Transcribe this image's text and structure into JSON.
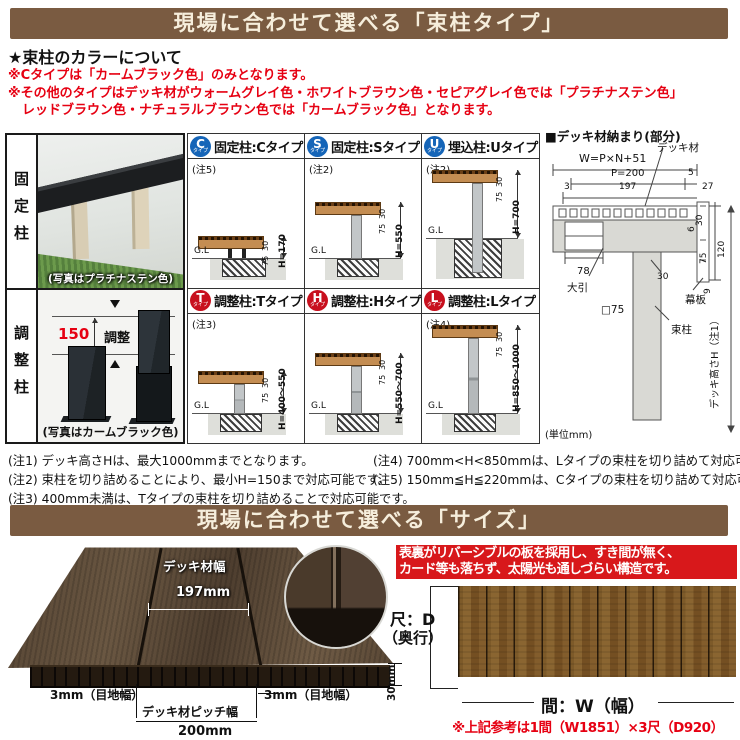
{
  "colors": {
    "banner_bg": "#7a5b41",
    "banner_text": "#f6eedc",
    "accent_red": "#e60012",
    "type_blue": "#1565b8",
    "type_red": "#c8101e",
    "feature_box_bg": "#d8181b"
  },
  "banner1": {
    "title": "現場に合わせて選べる「束柱タイプ」"
  },
  "color_info": {
    "heading": "★束柱のカラーについて",
    "line1": "※Cタイプは「カームブラック色」のみとなります。",
    "line2": "※その他のタイプはデッキ材がウォームグレイ色・ホワイトブラウン色・セピアグレイ色では「プラチナステン色」",
    "line3": "レッドブラウン色・ナチュラルブラウン色では「カームブラック色」となります。"
  },
  "left_panel": {
    "fixed": {
      "label": "固定柱",
      "caption": "(写真はプラチナステン色)"
    },
    "adjust": {
      "label": "調整柱",
      "dim": "150",
      "dim_text": "調整",
      "caption": "(写真はカームブラック色)"
    }
  },
  "type_table": {
    "unit": "(単位mm)",
    "gl": "G.L",
    "cells": [
      {
        "letter": "C",
        "sub": "タイプ",
        "title": "固定柱:Cタイプ",
        "note": "(注5)",
        "h": "H=170",
        "t1": "75",
        "t2": "30"
      },
      {
        "letter": "S",
        "sub": "タイプ",
        "title": "固定柱:Sタイプ",
        "note": "(注2)",
        "h": "H=550",
        "t1": "75",
        "t2": "30"
      },
      {
        "letter": "U",
        "sub": "タイプ",
        "title": "埋込柱:Uタイプ",
        "note": "(注2)",
        "h": "H=700",
        "t1": "75",
        "t2": "30"
      },
      {
        "letter": "T",
        "sub": "タイプ",
        "title": "調整柱:Tタイプ",
        "note": "(注3)",
        "h": "H=400～550",
        "t1": "75",
        "t2": "30"
      },
      {
        "letter": "H",
        "sub": "タイプ",
        "title": "調整柱:Hタイプ",
        "note": "",
        "h": "H=550～700",
        "t1": "75",
        "t2": "30"
      },
      {
        "letter": "L",
        "sub": "タイプ",
        "title": "調整柱:Lタイプ",
        "note": "(注4)",
        "h": "H=850～1000",
        "t1": "75",
        "t2": "30"
      }
    ]
  },
  "fitting_diagram": {
    "title": "■デッキ材納まり(部分)",
    "deck_label": "デッキ材",
    "w_formula": "W=P×N+51",
    "p": "P=200",
    "five": "5",
    "three": "3",
    "d197": "197",
    "d27": "27",
    "d30t": "30",
    "d6": "6",
    "d120": "120",
    "d75": "75",
    "d9": "9",
    "d30b": "30",
    "d78": "78",
    "obiki": "大引",
    "sq75": "□75",
    "makuita": "幕板",
    "tsukabashira": "束柱",
    "height_label": "デッキ高さH（注1）"
  },
  "notes": {
    "n1": "(注1) デッキ高さHは、最大1000mmまでとなります。",
    "n2": "(注2) 束柱を切り詰めることにより、最小H=150まで対応可能です。",
    "n3": "(注3) 400mm未満は、Tタイプの束柱を切り詰めることで対応可能です。",
    "n4": "(注4) 700mm<H<850mmは、Lタイプの束柱を切り詰めて対応可能です。",
    "n5": "(注5) 150mm≦H≦220mmは、Cタイプの束柱を切り詰めて対応可能です。"
  },
  "banner2": {
    "title": "現場に合わせて選べる「サイズ」"
  },
  "size_section": {
    "deck_width_label": "デッキ材幅",
    "deck_width_value": "197mm",
    "joint_left": "3mm（目地幅）",
    "joint_right": "3mm（目地幅）",
    "pitch_label": "デッキ材ピッチ幅",
    "pitch_value": "200mm",
    "thickness": "30mm",
    "feature_line1": "表裏がリバーシブルの板を採用し、すき間が無く、",
    "feature_line2": "カード等も落ちず、太陽光も通しづらい構造です。",
    "depth_line1": "尺：D",
    "depth_line2": "（奥行）",
    "width_label": "間：W（幅）",
    "reference": "※上記参考は1間（W1851）×3尺（D920）"
  }
}
